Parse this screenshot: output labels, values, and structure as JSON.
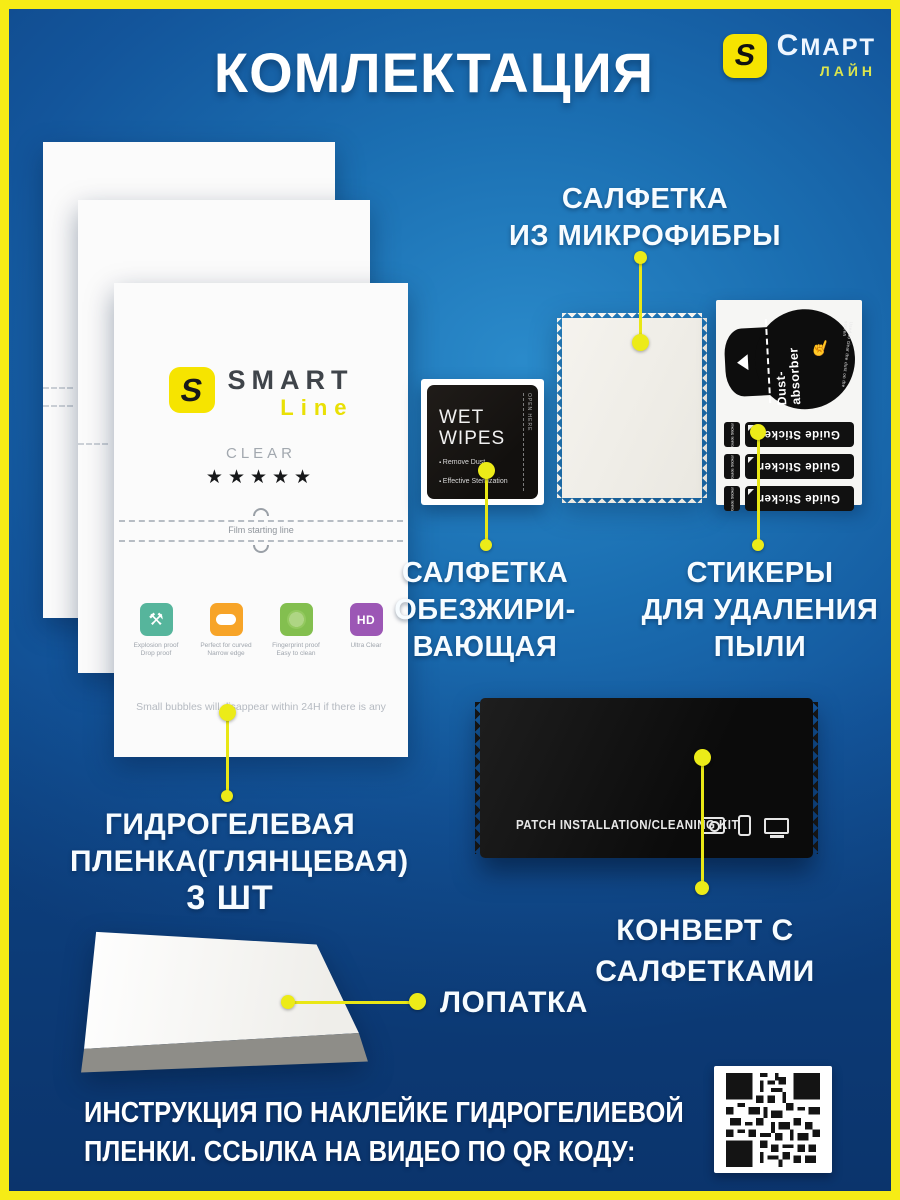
{
  "header": {
    "title": "КОМЛЕКТАЦИЯ",
    "brand_name": "Смарт",
    "brand_sub": "лайн",
    "brand_logo_letter": "S"
  },
  "film_sheet": {
    "logo_letter": "S",
    "brand": "SMART",
    "brand_line": "Line",
    "finish": "CLEAR",
    "stars": "★★★★★",
    "starting_line_note": "Film starting line",
    "features": [
      {
        "icon": "explosion-proof-icon",
        "glyph": "⚒",
        "line1": "Explosion proof",
        "line2": "Drop proof"
      },
      {
        "icon": "curved-edge-icon",
        "line1": "Perfect for curved",
        "line2": "Narrow edge"
      },
      {
        "icon": "fingerprint-proof-icon",
        "line1": "Fingerprint proof",
        "line2": "Easy to clean"
      },
      {
        "icon": "hd-icon",
        "label": "HD",
        "line1": "Ultra Clear",
        "line2": ""
      }
    ],
    "bubbles_note": "Small bubbles will disappear within 24H if there is any"
  },
  "wet_wipes": {
    "title_line1": "WET",
    "title_line2": "WIPES",
    "bullet1": "Remove Dust",
    "bullet2": "Effective Sterilization",
    "open_here": "OPEN HERE"
  },
  "sticker_sheet": {
    "dust_absorber_label": "Dust-absorber",
    "dust_absorber_note": "Used to clear the dust on the screen",
    "hand_glyph": "☝",
    "guide_sticker_label": "Guide Sticker"
  },
  "envelope": {
    "label": "PATCH INSTALLATION/CLEANING KIT"
  },
  "callouts": {
    "microfiber_l1": "САЛФЕТКА",
    "microfiber_l2": "ИЗ МИКРОФИБРЫ",
    "degreasing_l1": "САЛФЕТКА",
    "degreasing_l2": "ОБЕЗЖИРИ-",
    "degreasing_l3": "ВАЮЩАЯ",
    "stickers_l1": "СТИКЕРЫ",
    "stickers_l2": "ДЛЯ УДАЛЕНИЯ",
    "stickers_l3": "ПЫЛИ",
    "film_l1": "ГИДРОГЕЛЕВАЯ",
    "film_l2": "ПЛЕНКА(ГЛЯНЦЕВАЯ)",
    "film_qty": "3 ШТ",
    "envelope_l1": "КОНВЕРТ С",
    "envelope_l2": "САЛФЕТКАМИ",
    "spatula": "ЛОПАТКА"
  },
  "footer": {
    "line1": "ИНСТРУКЦИЯ ПО НАКЛЕЙКЕ ГИДРОГЕЛИЕВОЙ",
    "line2": "ПЛЕНКИ. ССЫЛКА НА ВИДЕО ПО  QR КОДУ:"
  },
  "colors": {
    "frame_yellow": "#f6ec16",
    "accent_yellow": "#e9e715",
    "logo_yellow": "#f6e400",
    "bg_blue_light": "#2a8aca",
    "bg_blue_dark": "#0e4485"
  }
}
